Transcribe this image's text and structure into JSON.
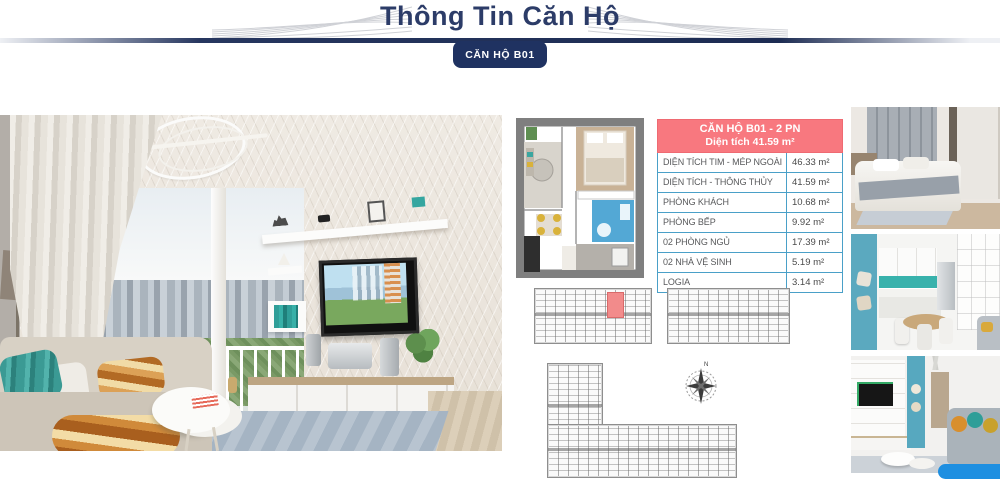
{
  "page": {
    "title": "Thông Tin Căn Hộ",
    "badge": "CĂN HỘ B01"
  },
  "spec_table": {
    "title_line1": "CĂN HỘ B01 - 2 PN",
    "title_line2": "Diện tích 41.59 m²",
    "rows": [
      {
        "label": "DIỆN TÍCH TIM - MÉP NGOÀI",
        "value": "46.33 m²"
      },
      {
        "label": "DIỆN TÍCH - THÔNG THỦY",
        "value": "41.59 m²"
      },
      {
        "label": "PHÒNG KHÁCH",
        "value": "10.68 m²"
      },
      {
        "label": "PHÒNG BẾP",
        "value": "9.92 m²"
      },
      {
        "label": "02 PHÒNG NGỦ",
        "value": "17.39 m²"
      },
      {
        "label": "02 NHÀ VỆ SINH",
        "value": "5.19 m²"
      },
      {
        "label": "LOGIA",
        "value": "3.14 m²"
      }
    ]
  },
  "compass": {
    "north_label": "N"
  },
  "images": {
    "main_photo": "living-room-render",
    "unit_plan": "apartment-b01-floor-plan",
    "site_plan_left": "building-floor-plan-with-b01-highlighted",
    "site_plan_right": "building-floor-plan",
    "site_plan_l_shape": "l-shaped-building-floor-plan",
    "thumb_1": "bedroom-render",
    "thumb_2": "kitchen-dining-render",
    "thumb_3": "living-room-tv-render"
  },
  "colors": {
    "accent_navy": "#1f3261",
    "title_navy": "#2c3c68",
    "table_header_pink": "#f8787f",
    "table_border_blue": "#4aa0c8",
    "highlighted_unit_red": "#f28b8b",
    "teal_accent": "#57a8bf",
    "chat_bar_blue": "#1e8fe1"
  }
}
